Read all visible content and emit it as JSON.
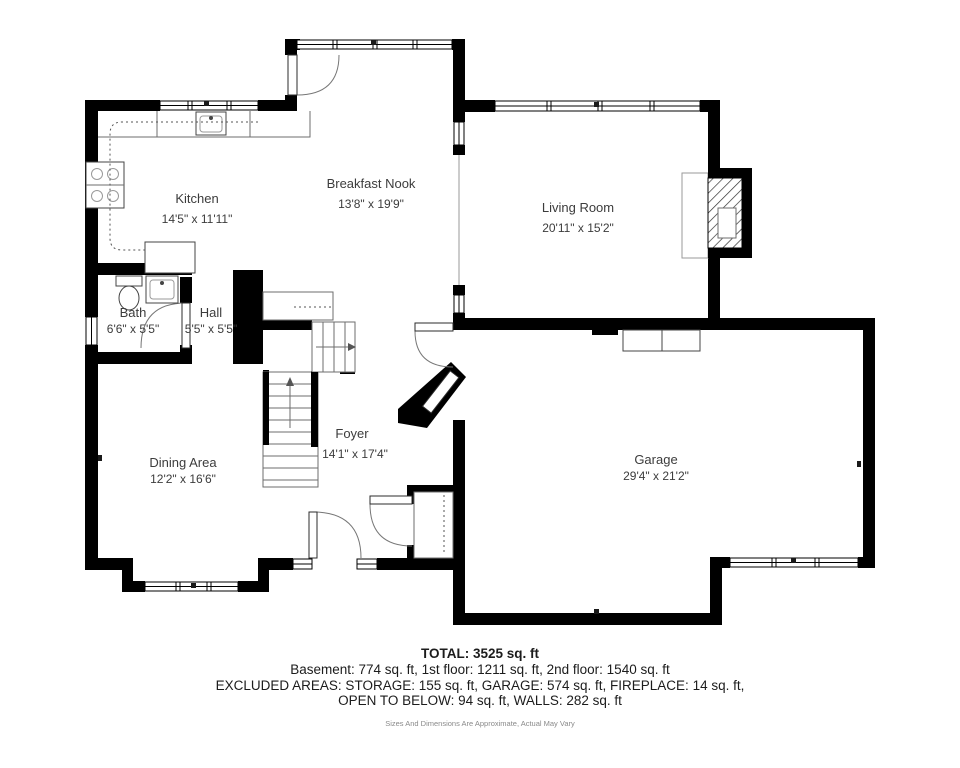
{
  "page": {
    "background": "#ffffff",
    "wall_color": "#000000",
    "label_color": "#3c3c3c"
  },
  "rooms": [
    {
      "id": "kitchen",
      "name": "Kitchen",
      "dimensions": "14'5\" x 11'11\""
    },
    {
      "id": "breakfast-nook",
      "name": "Breakfast Nook",
      "dimensions": "13'8\" x 19'9\""
    },
    {
      "id": "living-room",
      "name": "Living Room",
      "dimensions": "20'11\" x 15'2\""
    },
    {
      "id": "bath",
      "name": "Bath",
      "dimensions": "6'6\" x 5'5\""
    },
    {
      "id": "hall",
      "name": "Hall",
      "dimensions": "5'5\" x 5'5\""
    },
    {
      "id": "foyer",
      "name": "Foyer",
      "dimensions": "14'1\" x 17'4\""
    },
    {
      "id": "dining-area",
      "name": "Dining Area",
      "dimensions": "12'2\" x 16'6\""
    },
    {
      "id": "garage",
      "name": "Garage",
      "dimensions": "29'4\" x 21'2\""
    }
  ],
  "summary": {
    "total": "TOTAL: 3525 sq. ft",
    "floors": "Basement: 774 sq. ft, 1st floor: 1211 sq. ft, 2nd floor: 1540 sq. ft",
    "excluded_line1": "EXCLUDED AREAS: STORAGE: 155 sq. ft, GARAGE: 574 sq. ft, FIREPLACE: 14 sq. ft,",
    "excluded_line2": "OPEN TO BELOW: 94 sq. ft, WALLS: 282 sq. ft",
    "disclaimer": "Sizes And Dimensions Are Approximate, Actual May Vary"
  }
}
